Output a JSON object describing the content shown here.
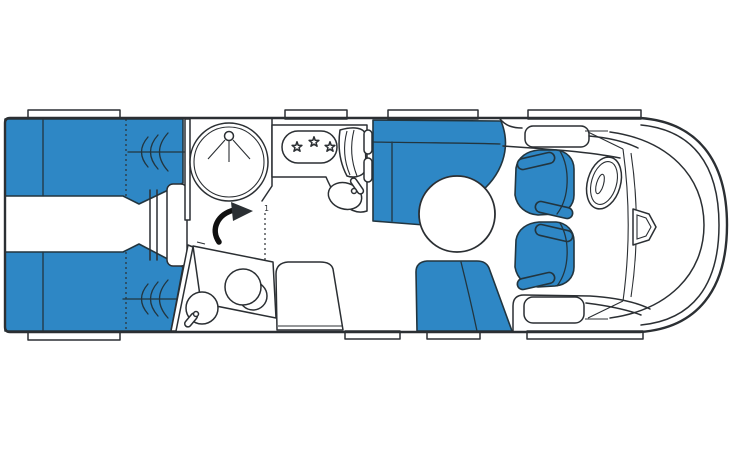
{
  "colors": {
    "furniture_blue": "#2e87c5",
    "outline": "#2b2f33",
    "background": "#ffffff"
  },
  "floorplan": {
    "annotations": {
      "door_marker": "1"
    },
    "counts": {
      "hob_burners": 3,
      "swivel_seats": 2,
      "top_windows": 4,
      "bottom_windows": 4
    },
    "features": [
      "rear-twin-beds",
      "bed-step",
      "front-wardrobe-cabinet",
      "shower-cabin",
      "toilet",
      "washbasin",
      "kitchen-hob",
      "kitchen-sink",
      "kitchen-drainer",
      "l-shaped-lounge-seat",
      "round-table",
      "bench-seat",
      "side-bench",
      "driver-swivel-seat",
      "passenger-swivel-seat",
      "steering-wheel",
      "windshield",
      "rear-view-mirror",
      "body-shell"
    ]
  }
}
